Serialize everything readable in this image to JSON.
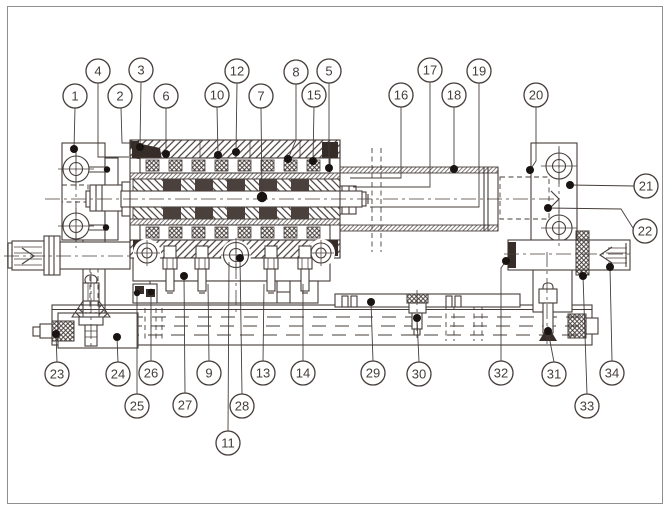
{
  "figure": {
    "type": "engineering-sectional-assembly-drawing",
    "description": "Cross-section assembly drawing of a cylinder unit with slider, guide tube, end caps, base rail and adjuster screws, annotated with numbered part callouts",
    "line_color": "#453d3a",
    "dark_fill_color": "#362d29",
    "dot_color": "#191311",
    "border_color": "#8f8f8f",
    "background_color": "#ffffff"
  },
  "balloons": [
    {
      "label": "1",
      "cx": 75,
      "cy": 96,
      "leader": [
        [
          75,
          108
        ],
        [
          74,
          149
        ]
      ],
      "dot": true
    },
    {
      "label": "4",
      "cx": 98,
      "cy": 71,
      "leader": [
        [
          98,
          83
        ],
        [
          98,
          157
        ],
        [
          129,
          157
        ]
      ],
      "dot": false
    },
    {
      "label": "2",
      "cx": 120,
      "cy": 96,
      "leader": [
        [
          121,
          108
        ],
        [
          122,
          143
        ],
        [
          131,
          143
        ]
      ],
      "dot": false
    },
    {
      "label": "3",
      "cx": 141,
      "cy": 70,
      "leader": [
        [
          141,
          82
        ],
        [
          140,
          147
        ]
      ],
      "dot": true
    },
    {
      "label": "6",
      "cx": 166,
      "cy": 96,
      "leader": [
        [
          166,
          108
        ],
        [
          166,
          154
        ]
      ],
      "dot": true
    },
    {
      "label": "10",
      "cx": 217,
      "cy": 95,
      "leader": [
        [
          217,
          107
        ],
        [
          218,
          155
        ]
      ],
      "dot": true
    },
    {
      "label": "12",
      "cx": 237,
      "cy": 71,
      "leader": [
        [
          237,
          83
        ],
        [
          236,
          152
        ]
      ],
      "dot": true
    },
    {
      "label": "7",
      "cx": 261,
      "cy": 96,
      "leader": [
        [
          261,
          108
        ],
        [
          262,
          197
        ]
      ],
      "dot": true,
      "dotR": 5.2
    },
    {
      "label": "8",
      "cx": 296,
      "cy": 72,
      "leader": [
        [
          296,
          84
        ],
        [
          296,
          140
        ],
        [
          288,
          159
        ]
      ],
      "dot": true
    },
    {
      "label": "15",
      "cx": 314,
      "cy": 95,
      "leader": [
        [
          314,
          107
        ],
        [
          313,
          161
        ]
      ],
      "dot": true
    },
    {
      "label": "5",
      "cx": 329,
      "cy": 71,
      "leader": [
        [
          329,
          83
        ],
        [
          329,
          168
        ]
      ],
      "dot": true
    },
    {
      "label": "16",
      "cx": 401,
      "cy": 95,
      "leader": [
        [
          401,
          107
        ],
        [
          401,
          178
        ],
        [
          350,
          178
        ]
      ],
      "dot": false
    },
    {
      "label": "17",
      "cx": 430,
      "cy": 70,
      "leader": [
        [
          430,
          82
        ],
        [
          430,
          187
        ],
        [
          353,
          187
        ]
      ],
      "dot": false
    },
    {
      "label": "18",
      "cx": 454,
      "cy": 95,
      "leader": [
        [
          454,
          107
        ],
        [
          454,
          169
        ]
      ],
      "dot": true
    },
    {
      "label": "19",
      "cx": 479,
      "cy": 71,
      "leader": [
        [
          479,
          83
        ],
        [
          479,
          207
        ],
        [
          370,
          207
        ]
      ],
      "dot": false
    },
    {
      "label": "20",
      "cx": 536,
      "cy": 95,
      "leader": [
        [
          536,
          107
        ],
        [
          536,
          161
        ],
        [
          530,
          170
        ]
      ],
      "dot": true
    },
    {
      "label": "21",
      "cx": 646,
      "cy": 186,
      "leader": [
        [
          634,
          186
        ],
        [
          570,
          185
        ]
      ],
      "dot": true
    },
    {
      "label": "22",
      "cx": 645,
      "cy": 231,
      "leader": [
        [
          633,
          228
        ],
        [
          621,
          209
        ],
        [
          548,
          208
        ]
      ],
      "dot": true
    },
    {
      "label": "23",
      "cx": 57,
      "cy": 374,
      "leader": [
        [
          57,
          362
        ],
        [
          56,
          334
        ]
      ],
      "dot": true
    },
    {
      "label": "24",
      "cx": 118,
      "cy": 374,
      "leader": [
        [
          118,
          362
        ],
        [
          117,
          337
        ]
      ],
      "dot": true
    },
    {
      "label": "25",
      "cx": 137,
      "cy": 406,
      "leader": [
        [
          137,
          394
        ],
        [
          137,
          293
        ]
      ],
      "dot": true,
      "dotR": 3.2
    },
    {
      "label": "26",
      "cx": 151,
      "cy": 373,
      "leader": [
        [
          151,
          361
        ],
        [
          151,
          292
        ]
      ],
      "dot": true,
      "dotR": 3.2
    },
    {
      "label": "27",
      "cx": 185,
      "cy": 405,
      "leader": [
        [
          185,
          393
        ],
        [
          184,
          276
        ]
      ],
      "dot": true
    },
    {
      "label": "9",
      "cx": 209,
      "cy": 373,
      "leader": [
        [
          209,
          361
        ],
        [
          208,
          284
        ]
      ],
      "dot": false
    },
    {
      "label": "28",
      "cx": 242,
      "cy": 406,
      "leader": [
        [
          242,
          394
        ],
        [
          240,
          258
        ]
      ],
      "dot": true
    },
    {
      "label": "13",
      "cx": 263,
      "cy": 373,
      "leader": [
        [
          263,
          361
        ],
        [
          264,
          284
        ]
      ],
      "dot": false
    },
    {
      "label": "14",
      "cx": 303,
      "cy": 373,
      "leader": [
        [
          303,
          361
        ],
        [
          303,
          284
        ]
      ],
      "dot": false
    },
    {
      "label": "11",
      "cx": 228,
      "cy": 443,
      "leader": [
        [
          228,
          431
        ],
        [
          229,
          262
        ]
      ],
      "dot": false
    },
    {
      "label": "29",
      "cx": 373,
      "cy": 373,
      "leader": [
        [
          373,
          361
        ],
        [
          371,
          302
        ]
      ],
      "dot": true
    },
    {
      "label": "30",
      "cx": 419,
      "cy": 374,
      "leader": [
        [
          419,
          362
        ],
        [
          417,
          318
        ]
      ],
      "dot": true
    },
    {
      "label": "32",
      "cx": 501,
      "cy": 373,
      "leader": [
        [
          501,
          361
        ],
        [
          501,
          268
        ],
        [
          506,
          261
        ]
      ],
      "dot": true
    },
    {
      "label": "31",
      "cx": 554,
      "cy": 374,
      "leader": [
        [
          554,
          362
        ],
        [
          548,
          331
        ]
      ],
      "dot": true
    },
    {
      "label": "33",
      "cx": 587,
      "cy": 406,
      "leader": [
        [
          587,
          394
        ],
        [
          583,
          276
        ]
      ],
      "dot": true
    },
    {
      "label": "34",
      "cx": 612,
      "cy": 373,
      "leader": [
        [
          612,
          361
        ],
        [
          610,
          267
        ]
      ],
      "dot": true
    }
  ]
}
